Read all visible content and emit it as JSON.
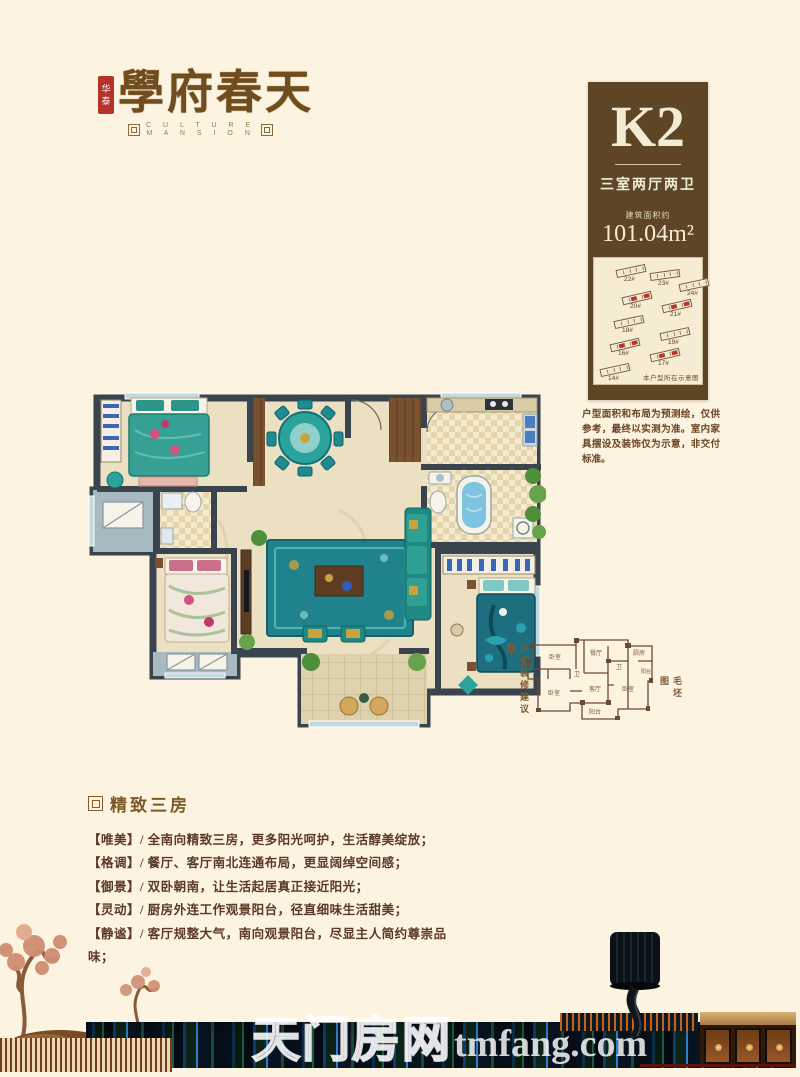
{
  "page": {
    "background": "#fcf3e1"
  },
  "brand": {
    "seal_text_top": "华",
    "seal_text_bottom": "泰",
    "title": "學府春天",
    "subtitle_line1": "C U L T U R E",
    "subtitle_line2": "M A N S I O N"
  },
  "unit_card": {
    "code": "K2",
    "layout": "三室两厅两卫",
    "area_label": "建筑面积约",
    "area_value": "101.04m²",
    "site_map": {
      "caption": "本户型所在示意图",
      "buildings": [
        {
          "id": "22#",
          "x": 22,
          "y": 9,
          "rot": -12,
          "highlight": false
        },
        {
          "id": "23#",
          "x": 56,
          "y": 13,
          "rot": -8,
          "highlight": false
        },
        {
          "id": "24#",
          "x": 85,
          "y": 23,
          "rot": -12,
          "highlight": false
        },
        {
          "id": "20#",
          "x": 28,
          "y": 36,
          "rot": -13,
          "highlight": true
        },
        {
          "id": "21#",
          "x": 68,
          "y": 44,
          "rot": -13,
          "highlight": true
        },
        {
          "id": "18#",
          "x": 20,
          "y": 60,
          "rot": -12,
          "highlight": false
        },
        {
          "id": "19#",
          "x": 66,
          "y": 72,
          "rot": -12,
          "highlight": false
        },
        {
          "id": "16#",
          "x": 16,
          "y": 83,
          "rot": -13,
          "highlight": true
        },
        {
          "id": "17#",
          "x": 56,
          "y": 93,
          "rot": -13,
          "highlight": true
        },
        {
          "id": "14#",
          "x": 6,
          "y": 108,
          "rot": -12,
          "highlight": false
        }
      ]
    }
  },
  "disclaimer": "户型面积和布局为预测绘，仅供参考，最终以实测为准。室内家具摆设及装饰仅为示意，非交付标准。",
  "floor_plan": {
    "decorated_label": "户型装修建议图",
    "bare_label": "毛坯图",
    "rooms": [
      "卧室",
      "餐厅",
      "厨房",
      "卫",
      "卫",
      "阳台",
      "卧室",
      "客厅",
      "卧室",
      "阳台"
    ]
  },
  "features": {
    "heading": "精致三房",
    "items": [
      "【唯美】/ 全南向精致三房，更多阳光呵护，生活醇美绽放；",
      "【格调】/ 餐厅、客厅南北连通布局，更显阔绰空间感；",
      "【御景】/ 双卧朝南，让生活起居真正接近阳光；",
      "【灵动】/ 厨房外连工作观景阳台，径直细味生活甜美；",
      "【静谧】/ 客厅规整大气，南向观景阳台，尽显主人简约尊崇品味；"
    ]
  },
  "watermark": {
    "cn": "天门房网",
    "en": "tmfang.com"
  },
  "palette": {
    "brand_brown": "#6f4d1c",
    "box_brown": "#5e4526",
    "seal_red": "#b5342a",
    "highlight_red": "#c03028",
    "teal_accent": "#2aa39a",
    "wall_dark": "#3a444e",
    "floor_beige": "#ece0c2"
  }
}
